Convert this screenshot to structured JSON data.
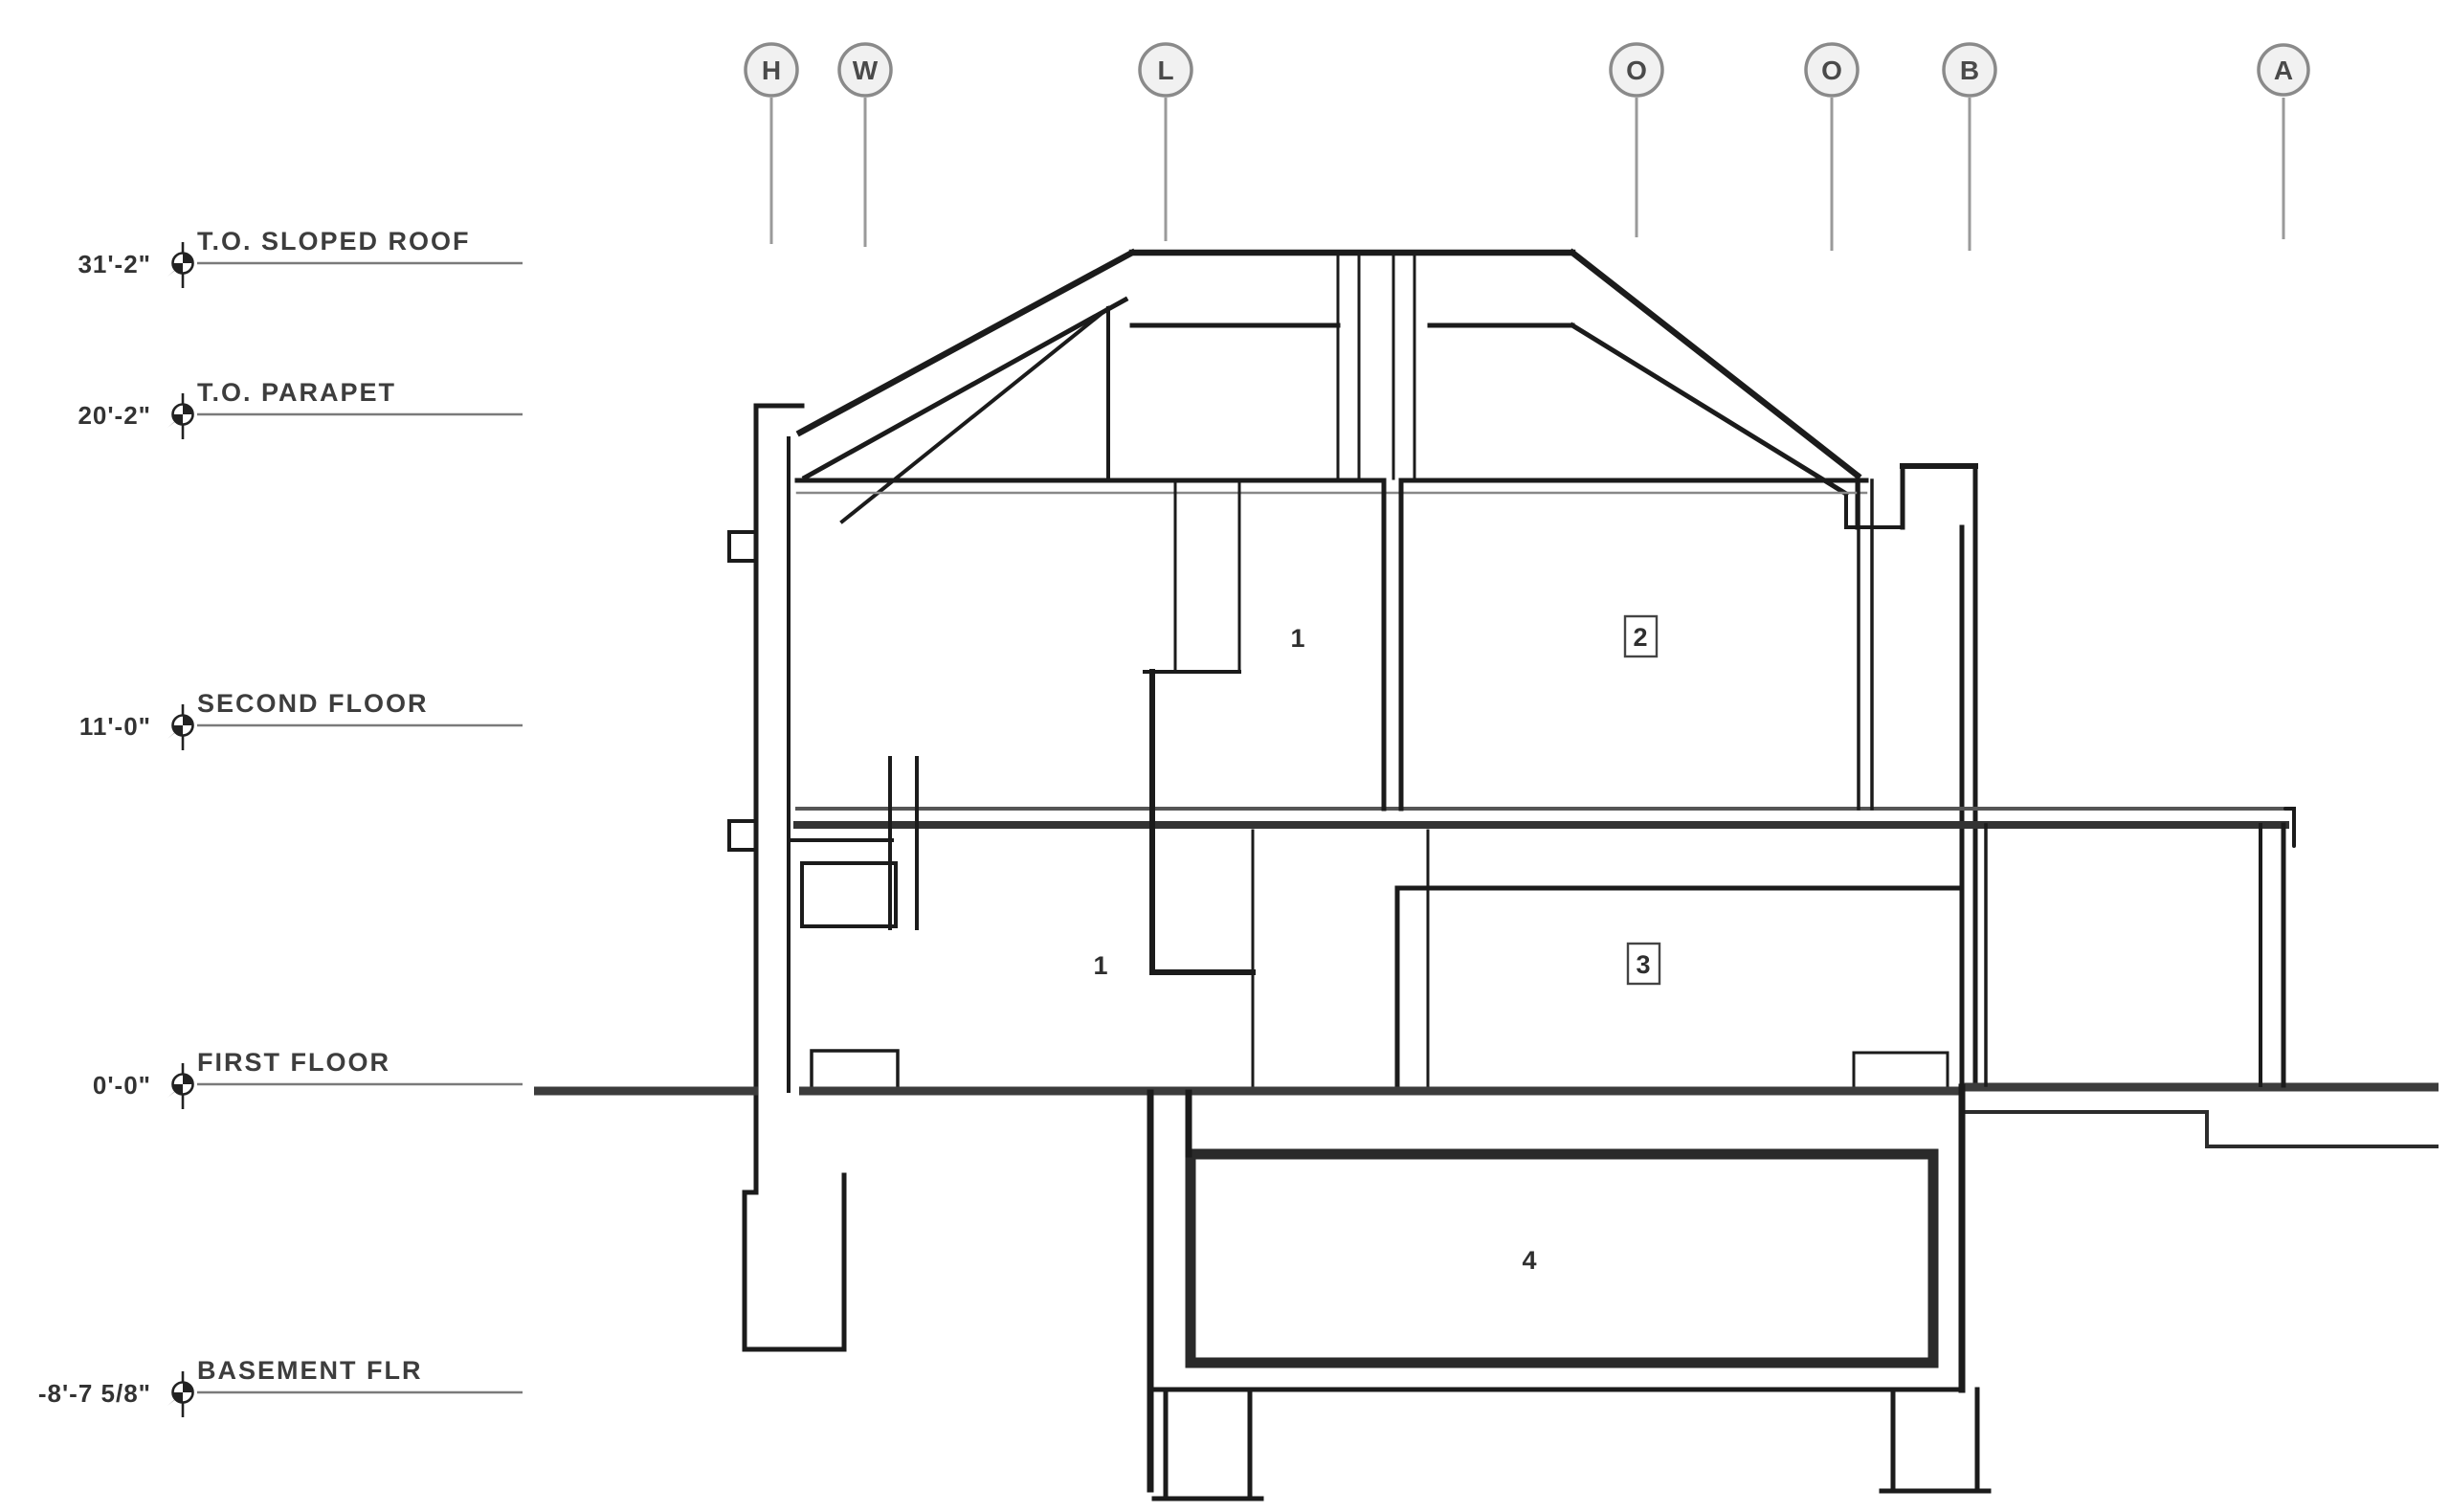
{
  "drawing": {
    "type": "architectural-building-section",
    "grid": {
      "bubbles": [
        {
          "label": "H"
        },
        {
          "label": "W"
        },
        {
          "label": "L"
        },
        {
          "label": "O"
        },
        {
          "label": "O"
        },
        {
          "label": "B"
        },
        {
          "label": "A"
        }
      ]
    },
    "elevations": [
      {
        "label": "T.O. SLOPED ROOF",
        "value": "31'-2\""
      },
      {
        "label": "T.O. PARAPET",
        "value": "20'-2\""
      },
      {
        "label": "SECOND FLOOR",
        "value": "11'-0\""
      },
      {
        "label": "FIRST FLOOR",
        "value": "0'-0\""
      },
      {
        "label": "BASEMENT FLR",
        "value": "-8'-7 5/8\""
      }
    ],
    "room_tags": [
      {
        "label": "1",
        "location": "upper-left-room"
      },
      {
        "label": "2",
        "location": "upper-right-room"
      },
      {
        "label": "1",
        "location": "main-left-room"
      },
      {
        "label": "3",
        "location": "main-right-room"
      },
      {
        "label": "4",
        "location": "basement-room"
      }
    ],
    "colors": {
      "line": "#1b1b1b",
      "heavy_line": "#3c3c3c",
      "leader": "#7a7a7a",
      "bubble_stroke": "#8a8a8a",
      "bubble_fill": "#f1f1f1",
      "text": "#3d3d3d",
      "background": "#ffffff"
    }
  }
}
